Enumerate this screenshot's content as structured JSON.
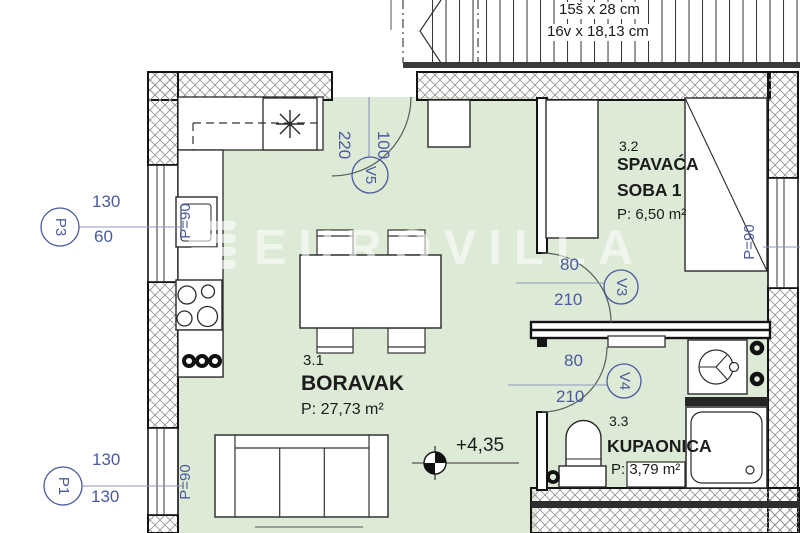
{
  "watermark": {
    "text": "EUROVILLA"
  },
  "stairs": {
    "dim_line1": "15š x 28 cm",
    "dim_line2": "16v x 18,13 cm"
  },
  "rooms": {
    "living": {
      "number": "3.1",
      "name": "BORAVAK",
      "area": "P: 27,73 m²"
    },
    "bedroom": {
      "number": "3.2",
      "name_line1": "SPAVAĆA",
      "name_line2": "SOBA 1",
      "area": "P: 6,50 m²"
    },
    "bathroom": {
      "number": "3.3",
      "name": "KUPAONICA",
      "area": "P: 3,79 m²"
    }
  },
  "elevation": {
    "value": "+4,35"
  },
  "openings": {
    "p3": {
      "label": "P3",
      "dim_top": "130",
      "dim_bottom": "60",
      "parapet": "P=90"
    },
    "p1": {
      "label": "P1",
      "dim_top": "130",
      "dim_bottom": "130",
      "parapet": "P=90"
    },
    "bedroom_window": {
      "parapet": "P=90"
    },
    "v5": {
      "label": "V5",
      "dim_height": "220",
      "dim_width": "100"
    },
    "v3": {
      "label": "V3",
      "dim_width": "80",
      "dim_height": "210"
    },
    "v4": {
      "label": "V4",
      "dim_width": "80",
      "dim_height": "210"
    }
  },
  "colors": {
    "floor": "#dcead6",
    "annotation": "#4a5a9e",
    "dimension_line": "#8d97c2"
  }
}
